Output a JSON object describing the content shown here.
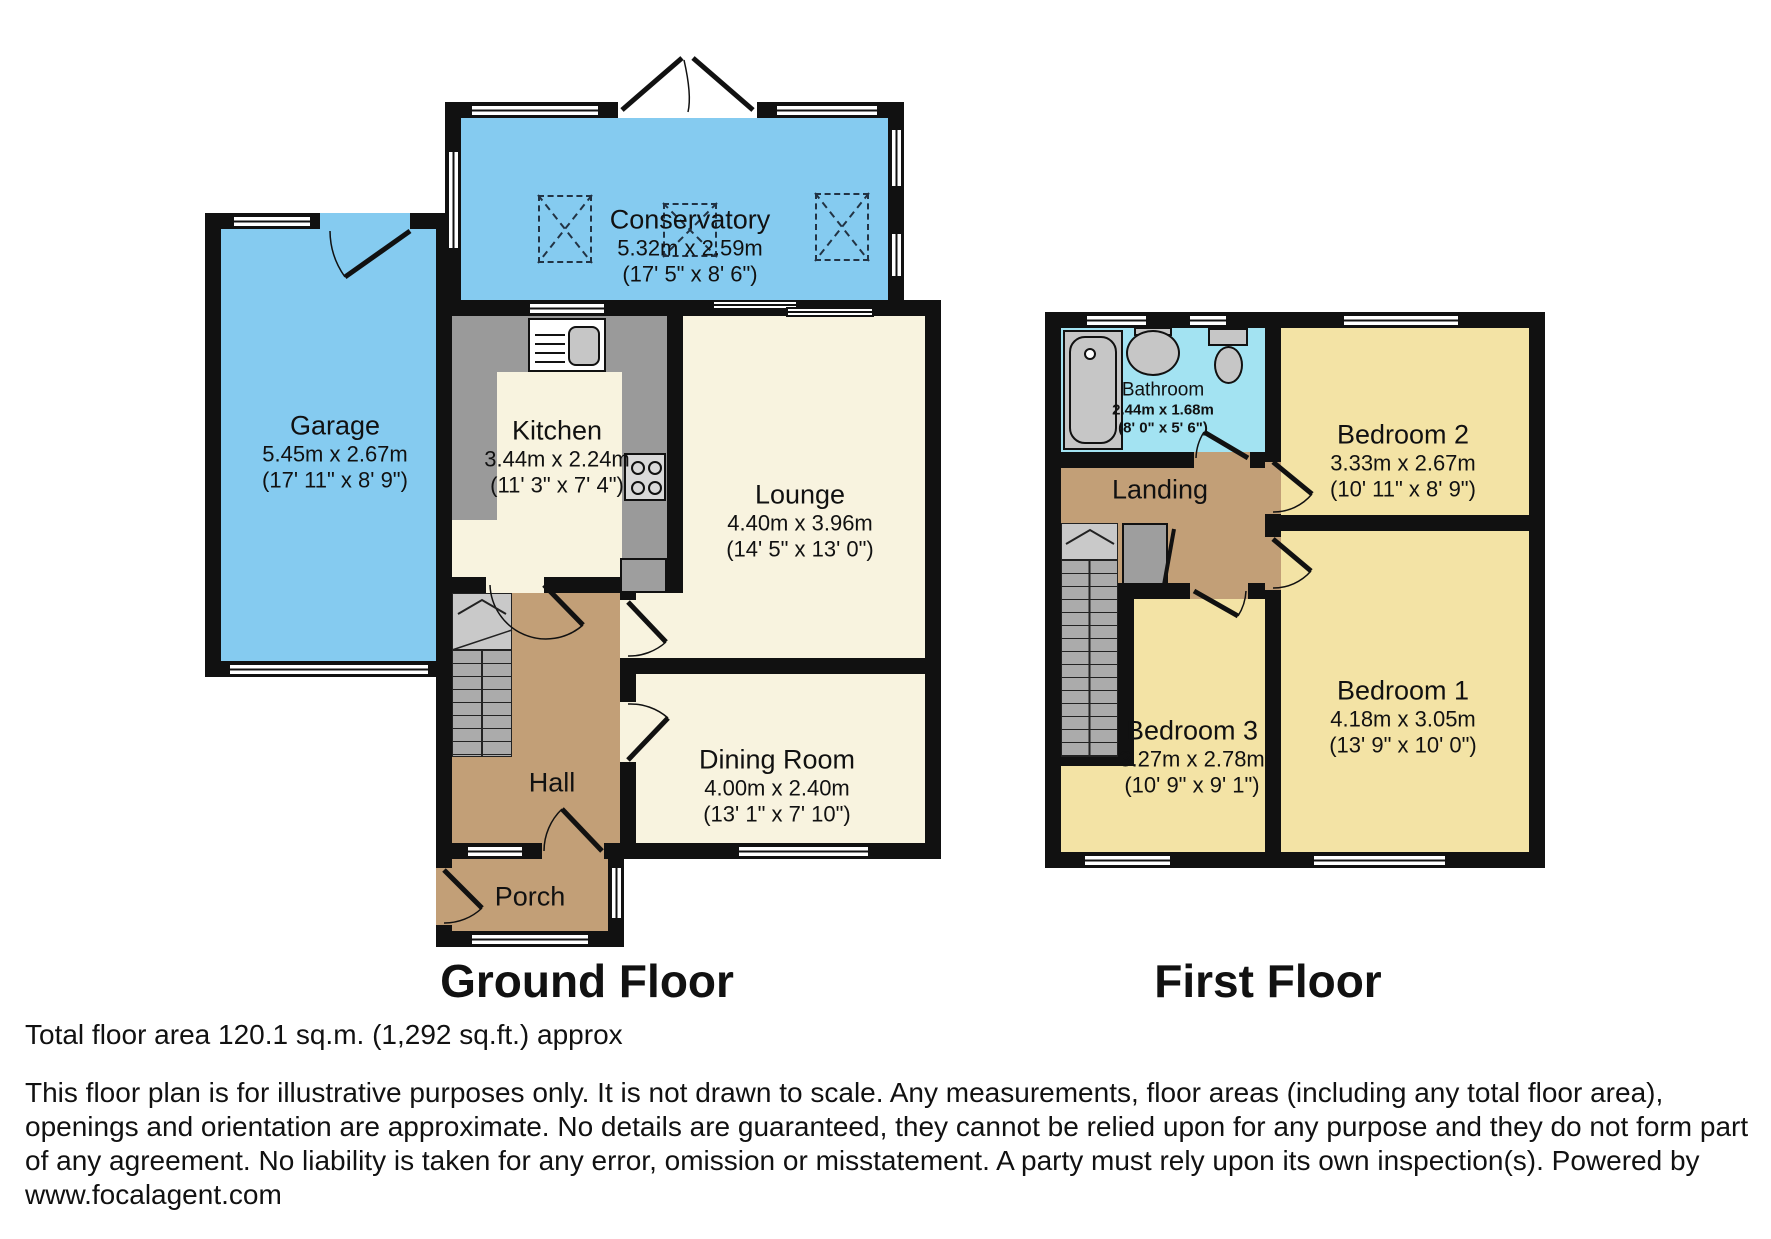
{
  "ground_floor": {
    "label": "Ground Floor",
    "rooms": {
      "conservatory": {
        "name": "Conservatory",
        "metric": "5.32m x 2.59m",
        "imperial": "(17' 5\" x 8' 6\")"
      },
      "garage": {
        "name": "Garage",
        "metric": "5.45m x 2.67m",
        "imperial": "(17' 11\" x 8' 9\")"
      },
      "kitchen": {
        "name": "Kitchen",
        "metric": "3.44m x 2.24m",
        "imperial": "(11' 3\" x 7' 4\")"
      },
      "lounge": {
        "name": "Lounge",
        "metric": "4.40m x 3.96m",
        "imperial": "(14' 5\" x 13' 0\")"
      },
      "hall": {
        "name": "Hall"
      },
      "dining": {
        "name": "Dining Room",
        "metric": "4.00m x 2.40m",
        "imperial": "(13' 1\" x 7' 10\")"
      },
      "porch": {
        "name": "Porch"
      }
    }
  },
  "first_floor": {
    "label": "First Floor",
    "rooms": {
      "bathroom": {
        "name": "Bathroom",
        "metric": "2.44m x 1.68m",
        "imperial": "(8' 0\" x 5' 6\")"
      },
      "bedroom2": {
        "name": "Bedroom 2",
        "metric": "3.33m x 2.67m",
        "imperial": "(10' 11\" x 8' 9\")"
      },
      "landing": {
        "name": "Landing"
      },
      "bedroom3": {
        "name": "Bedroom 3",
        "metric": "3.27m x 2.78m",
        "imperial": "(10' 9\" x 9' 1\")"
      },
      "bedroom1": {
        "name": "Bedroom 1",
        "metric": "4.18m x 3.05m",
        "imperial": "(13' 9\" x 10' 0\")"
      }
    }
  },
  "footer": {
    "total_area": "Total floor area 120.1 sq.m. (1,292 sq.ft.) approx",
    "disclaimer": "This floor plan is for illustrative purposes only. It is not drawn to scale. Any measurements, floor areas (including any total floor area), openings and orientation are approximate. No details are guaranteed, they cannot be relied upon for any purpose and they do not form part of any agreement. No liability is taken for any error, omission or misstatement. A party must rely upon its own inspection(s). Powered by www.focalagent.com"
  },
  "colors": {
    "wall": "#111111",
    "blue": "#85CBF0",
    "cyan": "#A3E3F2",
    "cream": "#F8F3DF",
    "yellow": "#F3E3A5",
    "brown": "#C29F77",
    "counter": "#9A9A9A",
    "fixture": "#C6C6C6"
  }
}
